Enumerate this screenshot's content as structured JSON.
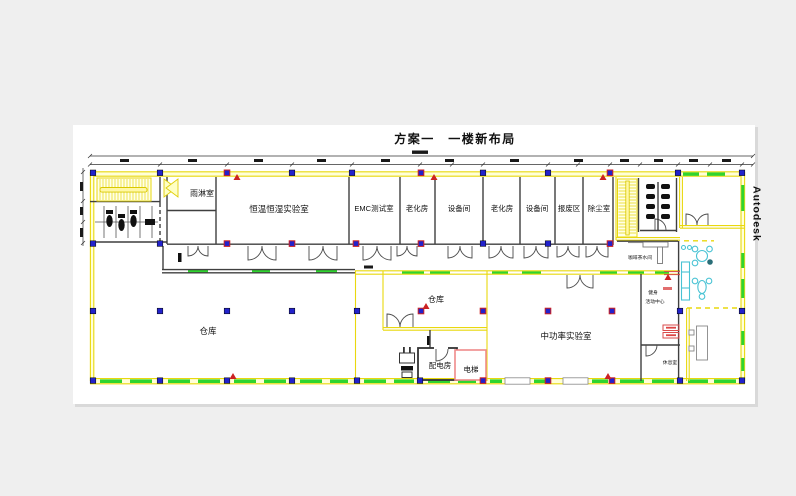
{
  "title": "方案一　一楼新布局",
  "watermark": "Autodesk",
  "labels": {
    "rain": "雨淋室",
    "humidity_lab": "恒温恒湿实验室",
    "emc": "EMC测试室",
    "aging1": "老化房",
    "equip1": "设备间",
    "aging2": "老化房",
    "equip2": "设备间",
    "scrap": "报废区",
    "dust": "除尘室",
    "warehouse_big": "仓库",
    "warehouse_small": "仓库",
    "power_room": "配电房",
    "elevator": "电梯",
    "mid_power_lab": "中功率实验室",
    "coffee": "咖啡茶水间",
    "fitness1": "健身",
    "fitness2": "活动中心",
    "rest": "休息室"
  },
  "colors": {
    "canvas": "#ffffff",
    "background": "#efefef",
    "wall_yellow": "#e9d80e",
    "wall_fill": "#ffffd8",
    "green_dash": "#2fd42f",
    "column_blue": "#2222cc",
    "column_red_outline": "#cc2222",
    "dark_wall": "#3f3f3f",
    "elevator_red": "#ef8a8a",
    "furniture_cyan": "#49c3d4",
    "marker_red": "#cc2222"
  }
}
